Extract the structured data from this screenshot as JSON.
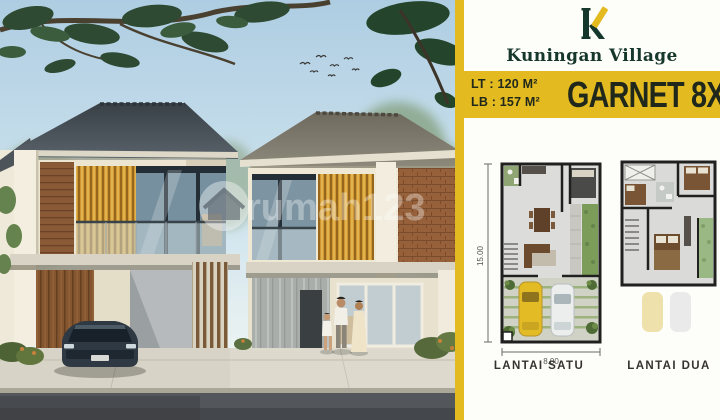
{
  "photo": {
    "watermark": "rumah123",
    "scene": "two-storey duplex house render with tree canopy, parked sedan, family of three"
  },
  "panel": {
    "brand_name": "Kuningan Village",
    "brand_tagline": "· · · · ·   · · · ·   · · · · ·",
    "specs": {
      "lt": "LT : 120 M²",
      "lb": "LB : 157 M²"
    },
    "product_title": "GARNET 8X15",
    "floorplans": [
      {
        "caption": "LANTAI SATU",
        "depth": "15.00",
        "width": "8.00"
      },
      {
        "caption": "LANTAI DUA"
      }
    ]
  },
  "colors": {
    "accent_yellow": "#e3ba20",
    "brand_green": "#16372c",
    "band_text": "#20281c",
    "plan_wall": "#20201e",
    "car_yellow": "#e3bc25",
    "roof_dark": "#4a525a"
  }
}
